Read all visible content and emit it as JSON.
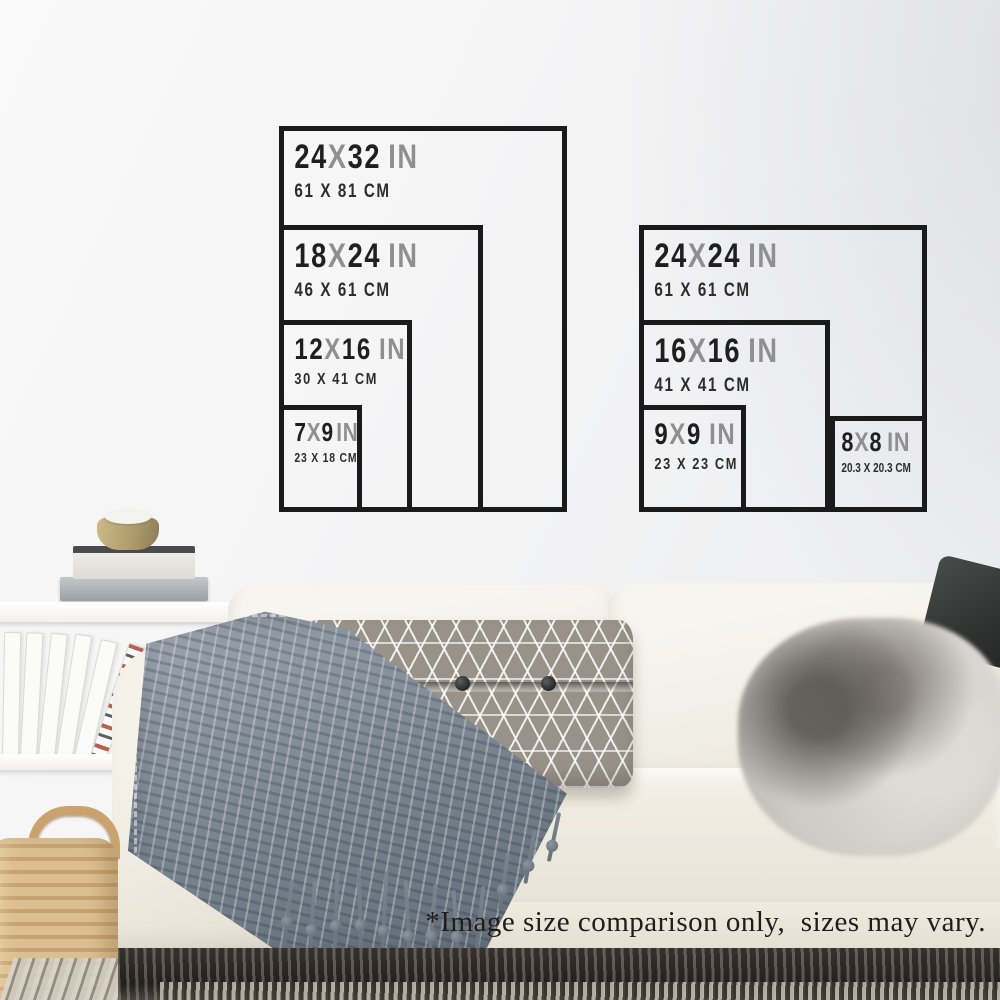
{
  "charts": {
    "left": {
      "title": "portrait-print-size-comparison",
      "sizes": [
        {
          "key": "24x32",
          "w": "24",
          "sep": "X",
          "h": "32",
          "unit": "IN",
          "cm": "61 X 81 CM"
        },
        {
          "key": "18x24",
          "w": "18",
          "sep": "X",
          "h": "24",
          "unit": "IN",
          "cm": "46 X 61 CM"
        },
        {
          "key": "12x16",
          "w": "12",
          "sep": "X",
          "h": "16",
          "unit": "IN",
          "cm": "30 X 41 CM"
        },
        {
          "key": "7x9",
          "w": "7",
          "sep": "X",
          "h": "9",
          "unit": "IN",
          "cm": "23 X 18 CM"
        }
      ]
    },
    "right": {
      "title": "square-print-size-comparison",
      "sizes": [
        {
          "key": "24x24",
          "w": "24",
          "sep": "X",
          "h": "24",
          "unit": "IN",
          "cm": "61 X 61 CM"
        },
        {
          "key": "16x16",
          "w": "16",
          "sep": "X",
          "h": "16",
          "unit": "IN",
          "cm": "41 X 41 CM"
        },
        {
          "key": "9x9",
          "w": "9",
          "sep": "X",
          "h": "9",
          "unit": "IN",
          "cm": "23 X 23 CM"
        },
        {
          "key": "8x8",
          "w": "8",
          "sep": "X",
          "h": "8",
          "unit": "IN",
          "cm": "20.3 X 20.3 CM"
        }
      ]
    }
  },
  "footer": {
    "disclaimer": "*Image size comparison only,  sizes may vary."
  },
  "colors": {
    "chart_line": "#1a1a1a",
    "number_text": "#1f1f1f",
    "grey_text": "#8f8f8f",
    "cm_text": "#2d2d2d",
    "sofa_cream": "#f1eee6",
    "blanket_grey": "#76818c",
    "basket_tan": "#d0ad7d"
  }
}
